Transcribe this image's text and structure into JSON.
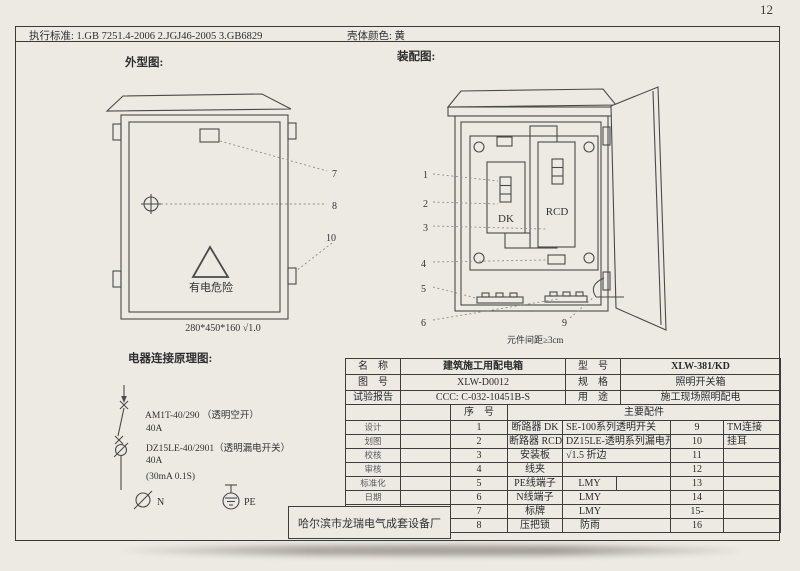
{
  "page_number": "12",
  "header": {
    "standards": "执行标准: 1.GB 7251.4-2006    2.JGJ46-2005    3.GB6829",
    "shell_color": "壳体颜色: 黄"
  },
  "outline": {
    "title": "外型图:",
    "warning": "有电危险",
    "dimension": "280*450*160 √1.0",
    "callouts": {
      "c7": "7",
      "c8": "8",
      "c10": "10"
    }
  },
  "assembly": {
    "title": "装配图:",
    "dk_label": "DK",
    "rcd_label": "RCD",
    "note": "元件间距≥3cm",
    "callouts": {
      "c1": "1",
      "c2": "2",
      "c3": "3",
      "c4": "4",
      "c5": "5",
      "c6": "6",
      "c9": "9"
    }
  },
  "schematic": {
    "title": "电器连接原理图:",
    "line1": "AM1T-40/290 （透明空开）",
    "line2": "40A",
    "line3": "DZ15LE-40/2901（透明漏电开关）",
    "line4": "40A",
    "line5": "(30mA 0.1S)",
    "n_label": "N",
    "pe_label": "PE"
  },
  "company": "哈尔滨市龙瑞电气成套设备厂",
  "table": {
    "info": [
      {
        "label": "名　称",
        "value": "建筑施工用配电箱",
        "label2": "型　号",
        "value2": "XLW-381/KD"
      },
      {
        "label": "图　号",
        "value": "XLW-D0012",
        "label2": "规　格",
        "value2": "照明开关箱"
      },
      {
        "label": "试验报告",
        "value": "CCC: C-032-10451B-S",
        "label2": "用　途",
        "value2": "施工现场照明配电"
      }
    ],
    "header": {
      "seq": "序　号",
      "parts": "主要配件"
    },
    "rows": [
      {
        "sig": "设计",
        "no": "1",
        "part": "断路器 DK",
        "spec": "SE-100系列透明开关",
        "no2": "9",
        "note": "TM连接"
      },
      {
        "sig": "划图",
        "no": "2",
        "part": "断路器 RCD",
        "spec": "DZ15LE-透明系列漏电开",
        "no2": "10",
        "note": "挂耳"
      },
      {
        "sig": "校核",
        "no": "3",
        "part": "安装板",
        "spec": "√1.5 折边",
        "no2": "11",
        "note": ""
      },
      {
        "sig": "审核",
        "no": "4",
        "part": "线夹",
        "spec": "",
        "no2": "12",
        "note": ""
      },
      {
        "sig": "标准化",
        "no": "5",
        "part": "PE线端子",
        "spec": "LMY",
        "no2": "13",
        "note": ""
      },
      {
        "sig": "日期",
        "no": "6",
        "part": "N线端子",
        "spec": "LMY",
        "no2": "14",
        "note": ""
      },
      {
        "sig": "",
        "no": "7",
        "part": "标牌",
        "spec": "LMY",
        "no2": "15-",
        "note": ""
      },
      {
        "sig": "",
        "no": "8",
        "part": "压把锁",
        "spec": "防雨",
        "no2": "16",
        "note": ""
      }
    ]
  }
}
